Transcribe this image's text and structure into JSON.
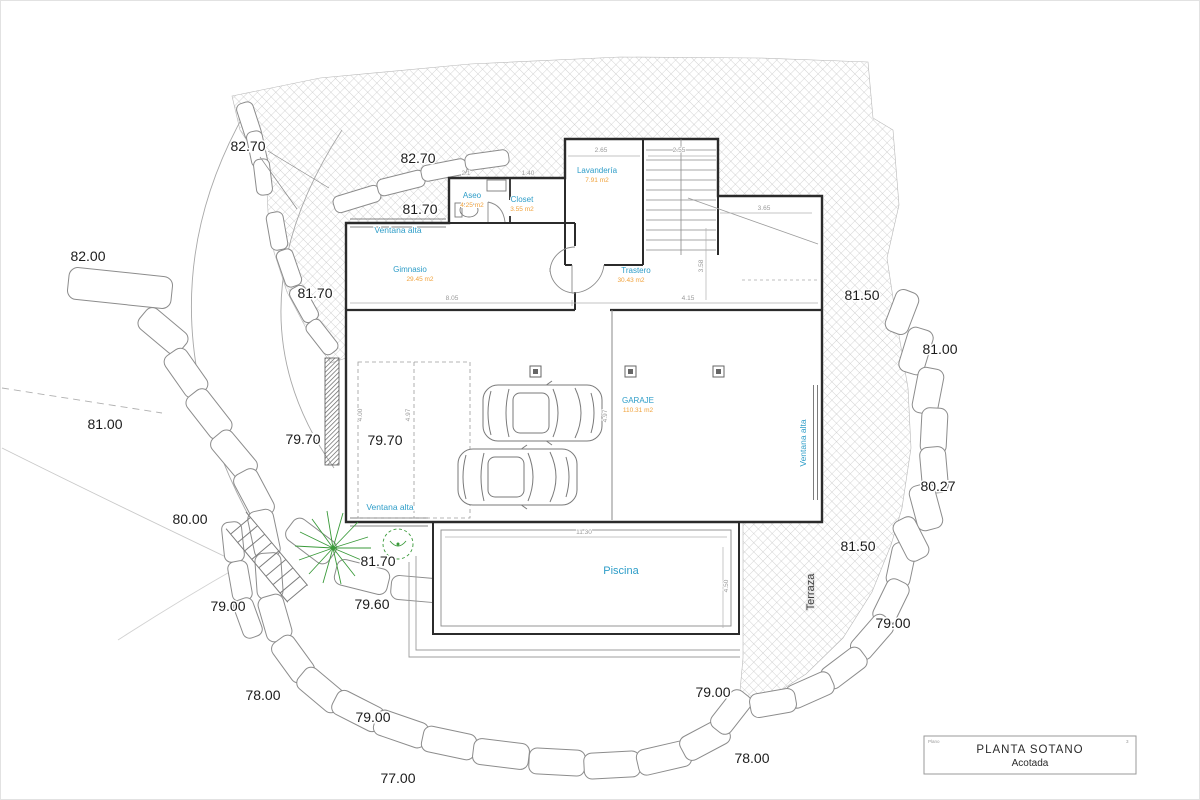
{
  "title_block": {
    "title": "PLANTA SOTANO",
    "subtitle": "Acotada",
    "left_note": "Plano",
    "right_note": "3"
  },
  "rooms": {
    "aseo": {
      "name": "Aseo",
      "area": "4.25 m2"
    },
    "closet": {
      "name": "Closet",
      "area": "3.55 m2"
    },
    "lavanderia": {
      "name": "Lavandería",
      "area": "7.91 m2"
    },
    "gimnasio": {
      "name": "Gimnasio",
      "area": "29.45 m2"
    },
    "trastero": {
      "name": "Trastero",
      "area": "30.43 m2"
    },
    "garaje": {
      "name": "GARAJE",
      "area": "110.31 m2"
    },
    "piscina": {
      "name": "Piscina"
    }
  },
  "annotations": {
    "ventana_top": "Ventana alta",
    "ventana_bottom": "Ventana alta",
    "ventana_right": "Ventana alta",
    "terraza": "Terraza"
  },
  "elevations": [
    {
      "text": "82.70"
    },
    {
      "text": "82.70"
    },
    {
      "text": "81.70"
    },
    {
      "text": "82.00"
    },
    {
      "text": "81.70"
    },
    {
      "text": "81.50"
    },
    {
      "text": "81.00"
    },
    {
      "text": "81.00"
    },
    {
      "text": "79.70"
    },
    {
      "text": "79.70"
    },
    {
      "text": "80.27"
    },
    {
      "text": "80.00"
    },
    {
      "text": "81.50"
    },
    {
      "text": "81.70"
    },
    {
      "text": "79.00"
    },
    {
      "text": "79.60"
    },
    {
      "text": "79.00"
    },
    {
      "text": "78.00"
    },
    {
      "text": "79.00"
    },
    {
      "text": "79.00"
    },
    {
      "text": "78.00"
    },
    {
      "text": "77.00"
    }
  ],
  "dimensions": [
    {
      "text": "2.1"
    },
    {
      "text": "1.40"
    },
    {
      "text": "2.65"
    },
    {
      "text": "2.55"
    },
    {
      "text": "3.65"
    },
    {
      "text": "8.05"
    },
    {
      "text": "4.15"
    },
    {
      "text": "3.58"
    },
    {
      "text": "11.30"
    },
    {
      "text": "4.50"
    },
    {
      "text": "4.00"
    },
    {
      "text": "4.97"
    },
    {
      "text": "4.97"
    }
  ],
  "colors": {
    "room_label": "#2e9dc8",
    "area_label": "#f0a23c",
    "wall": "#2b2b2b",
    "hatch": "#bfbfbf",
    "tree": "#3a9a3a",
    "dimension": "#9a9a9a",
    "elevation": "#1c1c1c"
  }
}
